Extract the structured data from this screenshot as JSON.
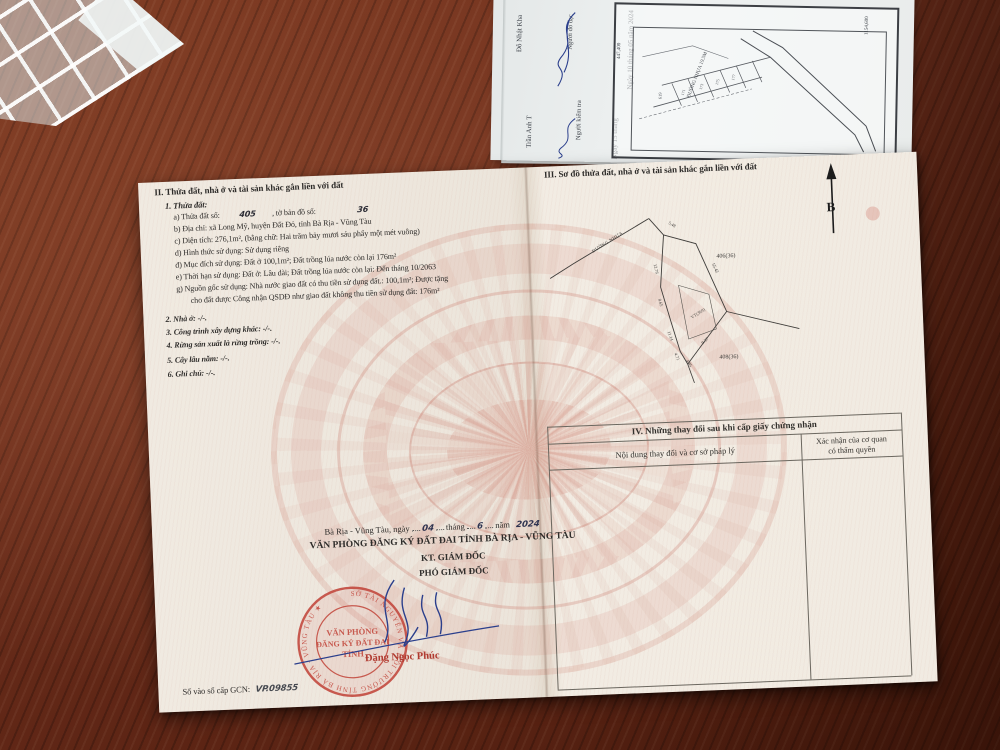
{
  "certificate": {
    "section2": {
      "title": "II. Thửa đất, nhà ở và tài sản khác gắn liền với đất",
      "item1": "1. Thửa đất:",
      "a_label": "a) Thửa đất số:",
      "a_value": "405",
      "a_label2": ", tờ bản đồ số:",
      "a_value2": "36",
      "b": "b) Địa chỉ:  xã Long Mỹ, huyện Đất Đỏ, tỉnh Bà Rịa - Vũng Tàu",
      "c": "c) Diện tích:  276,1m², (bằng chữ: Hai trăm bảy mươi sáu phẩy một mét vuông)",
      "d": "d) Hình thức sử dụng:  Sử dụng riêng",
      "dd": "đ) Mục đích sử dụng:  Đất ở 100,1m²; Đất trồng lúa nước còn lại 176m²",
      "e": "e) Thời hạn sử dụng:  Đất ở: Lâu dài; Đất trồng lúa nước còn lại: Đến tháng 10/2063",
      "g1": "g) Nguồn gốc sử dụng:  Nhà nước giao đất có thu tiền sử dụng đất.: 100,1m²; Được tặng",
      "g2": "cho đất được Công nhận QSDĐ như giao đất không thu tiền sử dụng đất: 176m²",
      "item2": "2. Nhà ở:  -/-.",
      "item3": "3. Công trình xây dựng khác: -/-.",
      "item4": "4. Rừng sản xuất là rừng trồng: -/-.",
      "item5": "5. Cây lâu năm:  -/-.",
      "item6": "6. Ghi chú: -/-."
    },
    "section3": {
      "title": "III. Sơ đồ thửa đất, nhà ở và tài sản khác gắn liền với đất",
      "north": "B",
      "road": "ĐƯỜNG NHỰA",
      "edge_top": "5.48",
      "edge_right": "55.42",
      "edge_l1": "12.76",
      "edge_l2": "8.65",
      "edge_l3": "11.14",
      "edge_l4": "4.71",
      "edge_b1": "4.85",
      "edge_b2": "9.37",
      "parcel_top": "406(36)",
      "parcel_bottom": "408(36)",
      "inner_label": "VT(369)"
    },
    "section4": {
      "title": "IV. Những thay đổi sau khi cấp giấy chứng nhận",
      "col1": "Nội dung thay đổi và cơ sở pháp lý",
      "col2a": "Xác nhận của cơ quan",
      "col2b": "có thẩm quyền"
    },
    "footer": {
      "place_label": "Bà Rịa - Vũng Tàu, ngày",
      "day": "04",
      "month_label": "tháng",
      "month": "6",
      "year_label": "năm",
      "year": "2024",
      "office": "VĂN PHÒNG ĐĂNG KÝ ĐẤT ĐAI TỈNH BÀ RỊA - VŨNG TÀU",
      "kt": "KT. GIÁM ĐỐC",
      "deputy": "PHÓ GIÁM ĐỐC",
      "signer": "Đặng Ngọc Phúc",
      "book_label": "Số vào sổ cấp GCN:",
      "book_value": "VP.09855",
      "seal_ring": "SỞ TÀI NGUYÊN VÀ MÔI TRƯỜNG TỈNH BÀ RỊA - VŨNG TÀU ★",
      "seal_line1": "VĂN PHÒNG",
      "seal_line2": "ĐĂNG KÝ ĐẤT ĐAI",
      "seal_line3": "TỈNH"
    }
  },
  "map_extract": {
    "date1": "Ngày 10 tháng 05 năm 2024",
    "role1": "Người đo đạc",
    "name1": "Đỗ Nhật Kha",
    "date2": "Ngày 15 tháng",
    "role2": "Người kiểm tra",
    "name2": "Trần Anh T",
    "coord1": "447,400",
    "coord2": "1154,600",
    "road": "ĐƯỜNG NHỰA 19.5M",
    "parcel_a": "619",
    "plot1": "171",
    "plot2": "173",
    "plot3": "175",
    "plot4": "177"
  }
}
